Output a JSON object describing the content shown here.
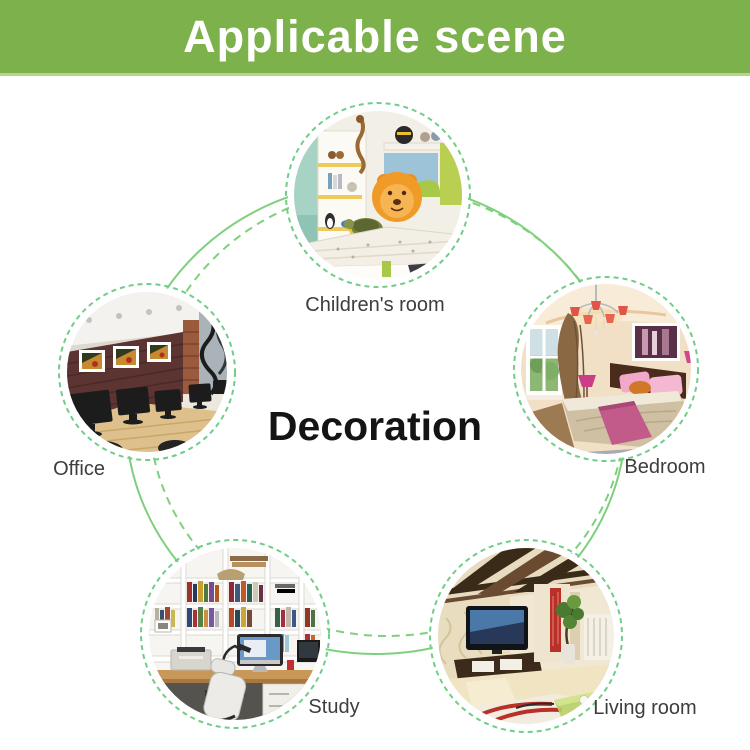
{
  "banner": {
    "title": "Applicable scene",
    "background": "#7db14b"
  },
  "center_label": "Decoration",
  "rooms": [
    {
      "id": "childrens-room",
      "label": "Children's room"
    },
    {
      "id": "office",
      "label": "Office"
    },
    {
      "id": "bedroom",
      "label": "Bedroom"
    },
    {
      "id": "study",
      "label": "Study"
    },
    {
      "id": "living-room",
      "label": "Living room"
    }
  ],
  "colors": {
    "banner_green": "#7db14b",
    "banner_highlight": "#b7d487",
    "connector_green": "#7fd07c",
    "ring_green": "#70cd87",
    "label_text": "#3d3d3d",
    "center_text": "#141414",
    "banner_text": "#ffffff"
  }
}
